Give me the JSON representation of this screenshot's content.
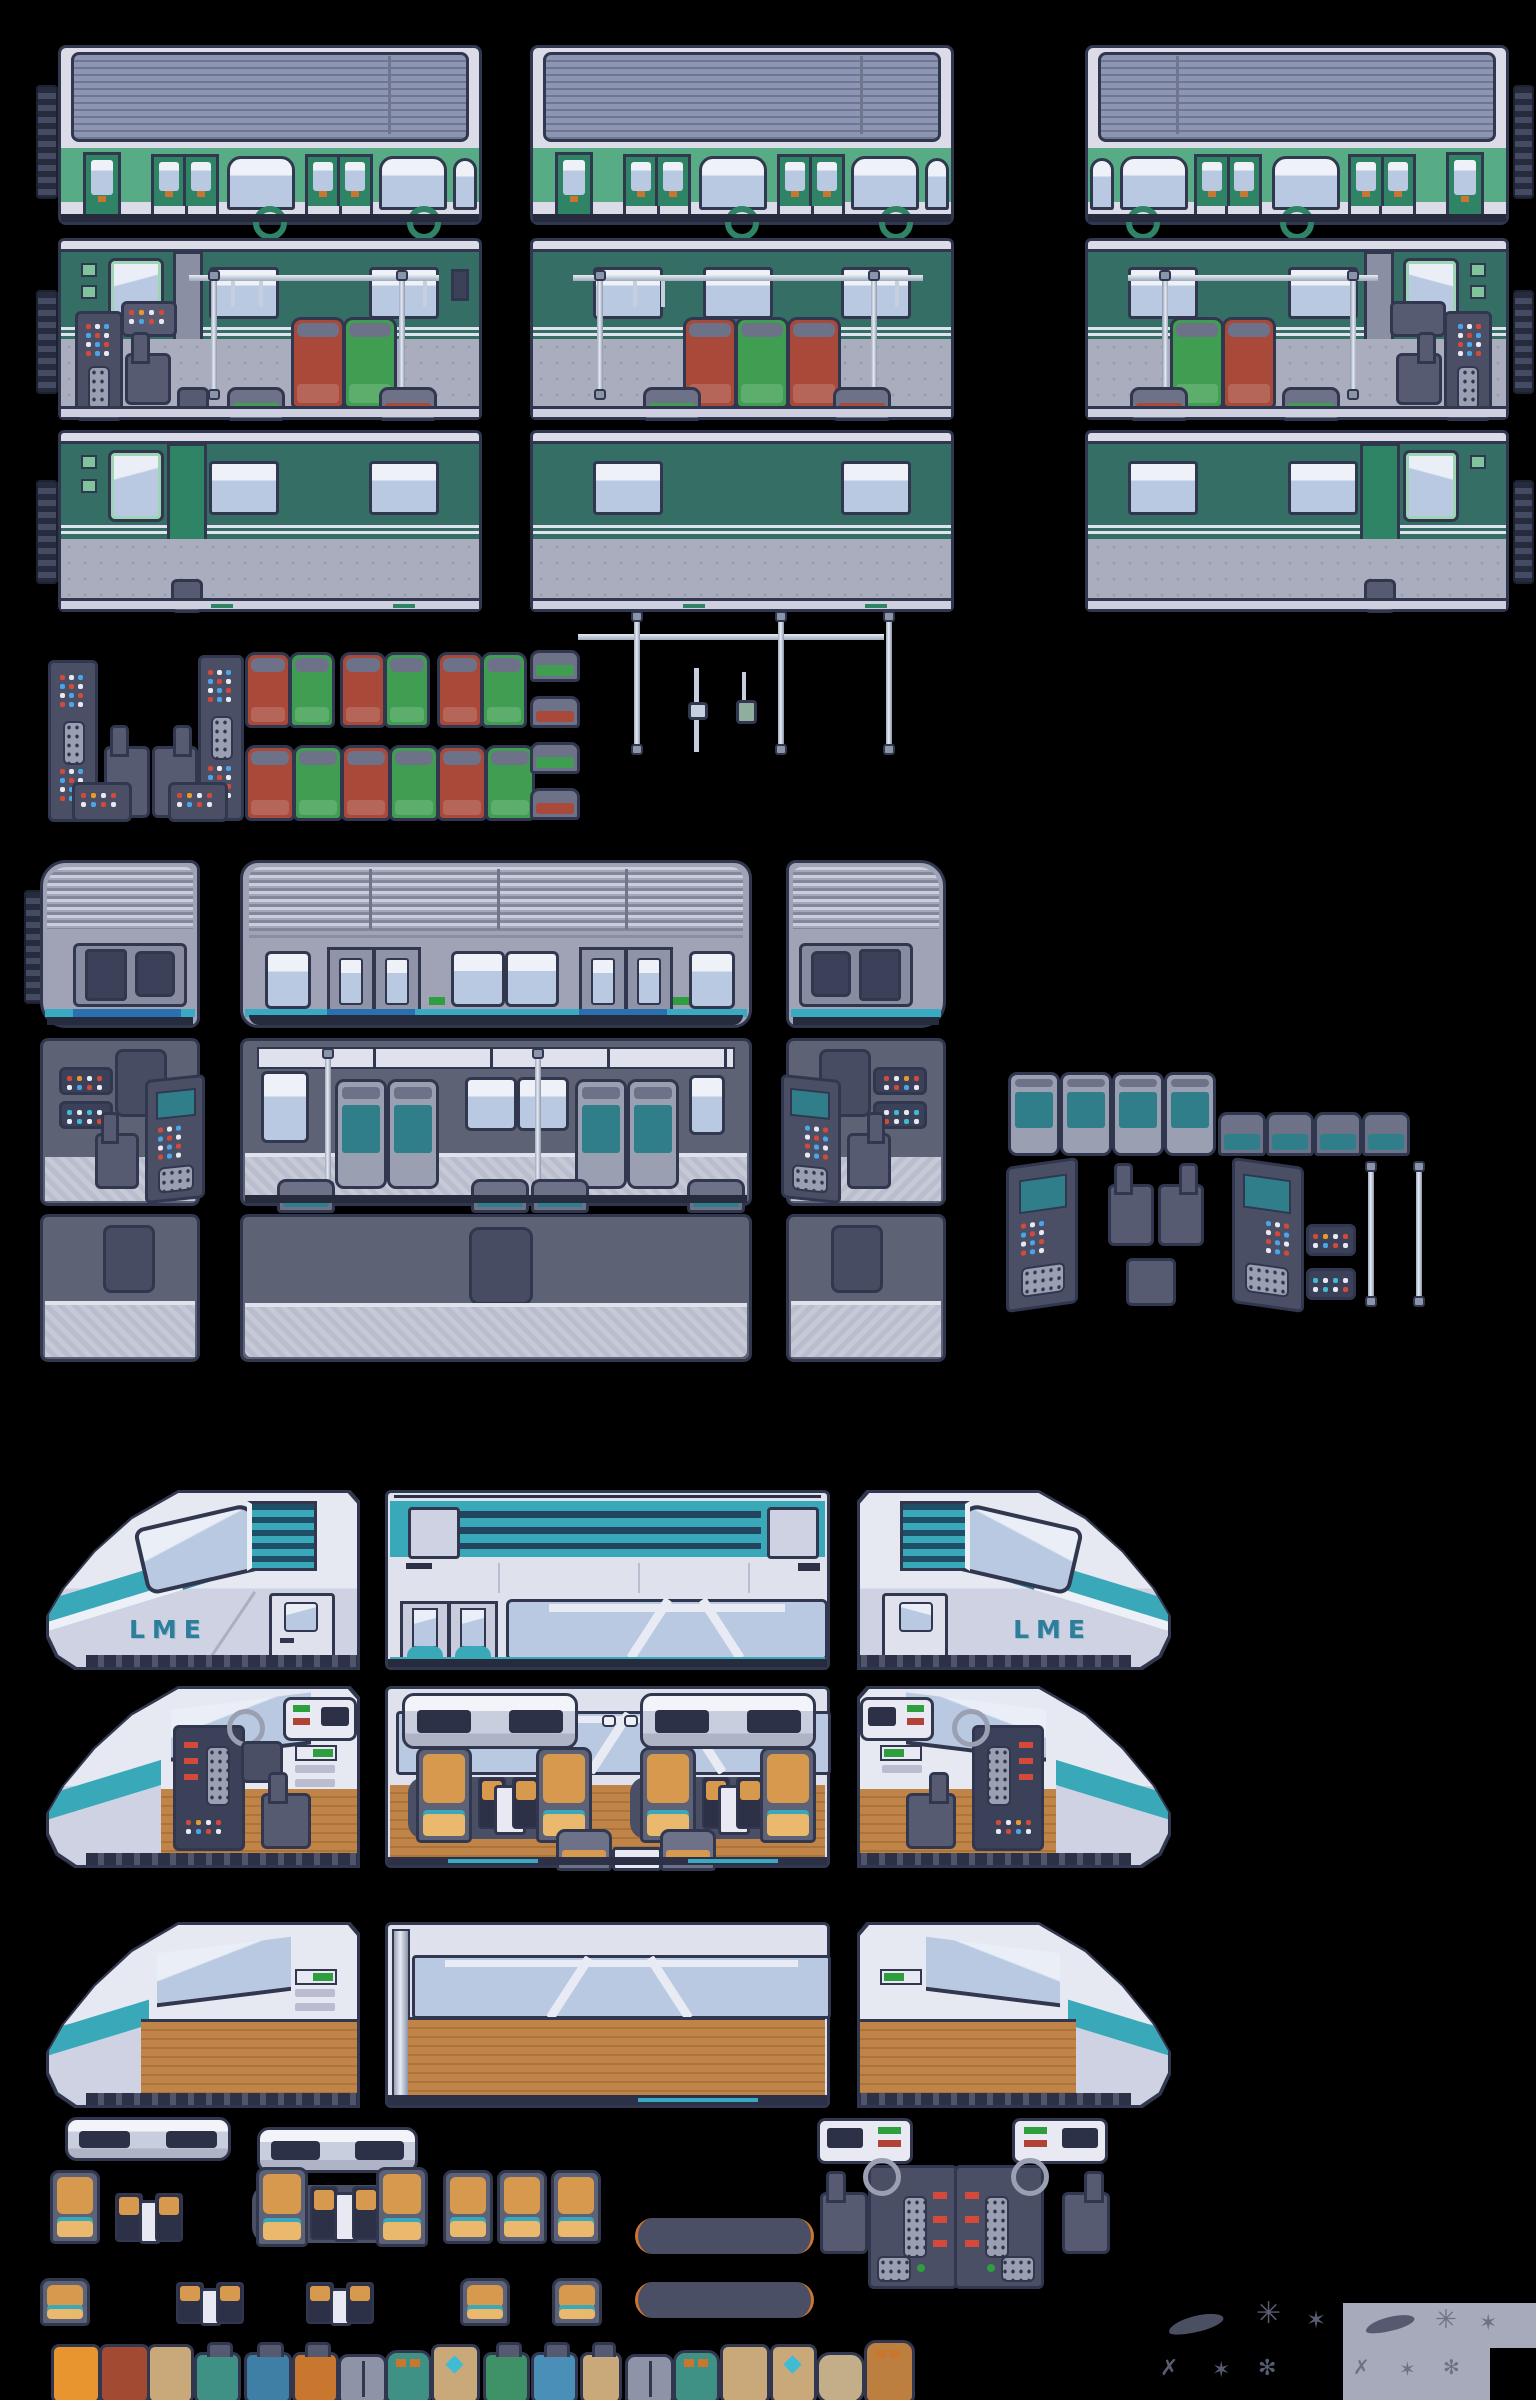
{
  "sheet": {
    "name": "pixel-art train tileset sprite sheet",
    "background": "#000000"
  },
  "labels": {
    "brand": "LME"
  },
  "palette": {
    "outline": "#31374e",
    "body_pale": "#dcdbe8",
    "roof_slate": "#8d95b5",
    "roof_line": "#70768e",
    "green_band": "#57ab85",
    "green_dark": "#2f8465",
    "teal_wall": "#356e64",
    "window_blue": "#bac9e2",
    "window_hi": "#e9eef7",
    "floor_gray": "#a9adbe",
    "floor_dot": "#989dae",
    "seat_red": "#a8493a",
    "seat_green": "#3f9e52",
    "seat_teal": "#2f7e8a",
    "pole": "#c5cfdd",
    "dark_panel": "#3c415a",
    "metal_body": "#9fa3b5",
    "metal_wall": "#5d6275",
    "floor_check_a": "#c6c9d6",
    "floor_check_b": "#b9bdce",
    "cyan_stripe": "#38aac2",
    "blue_stripe": "#2a6fae",
    "green_marker": "#2f9e3f",
    "lme_teal": "#39a9ba",
    "lme_navy": "#2c3147",
    "lme_body": "#dfe1ec",
    "lme_text": "#2e7d9c",
    "wood": "#c08448",
    "wood_dark": "#ab7539",
    "orange_seat": "#d7994e",
    "orange_cushion": "#eab96e",
    "gray_panel": "#a7aaba",
    "decal": "#585d72"
  },
  "sections": [
    {
      "name": "green-commuter-train",
      "rows": [
        "exterior",
        "interior",
        "interior-wall"
      ],
      "cars": 3
    },
    {
      "name": "green-train-parts",
      "items": [
        "control-panel-tower",
        "driver-seat",
        "control-console",
        "seat-pair-red-green",
        "seat-red",
        "seat-green",
        "seat-back-green",
        "seat-back-red"
      ]
    },
    {
      "name": "handrails",
      "items": [
        "ceiling-rail",
        "vertical-pole",
        "short-pole",
        "hand-strap"
      ]
    },
    {
      "name": "silver-metro-train",
      "rows": [
        "exterior",
        "interior",
        "interior-wall"
      ],
      "cars": [
        "cab-left",
        "middle",
        "cab-right"
      ]
    },
    {
      "name": "metro-parts",
      "items": [
        "seat-front",
        "seat-back",
        "cockpit-console-left",
        "cockpit-console-right",
        "driver-chair",
        "button-panel",
        "pole"
      ]
    },
    {
      "name": "lme-express-train",
      "rows": [
        "exterior",
        "interior",
        "interior-wall"
      ],
      "cars": [
        "head-left",
        "middle",
        "head-right"
      ]
    },
    {
      "name": "lme-parts",
      "items": [
        "luggage-rack",
        "seat-orange",
        "booth-table",
        "seat-group-with-table",
        "floor-mat",
        "galley-unit",
        "cockpit-console-pair",
        "driver-chair"
      ]
    },
    {
      "name": "luggage",
      "items": [
        "suitcase-orange",
        "suitcase-red",
        "suitcase-tan",
        "roller-teal",
        "roller-blue",
        "roller-orange",
        "bag-gray",
        "backpack-teal",
        "bag-diamond",
        "roller-green",
        "roller-blue",
        "roller-tan",
        "bag-gray",
        "backpack-teal",
        "suitcase-tan",
        "bag-diamond",
        "duffel-tan",
        "backpack-brown"
      ]
    },
    {
      "name": "decals",
      "items": [
        "scratch-splat",
        "crack-marks",
        "panel-swatch"
      ]
    }
  ]
}
